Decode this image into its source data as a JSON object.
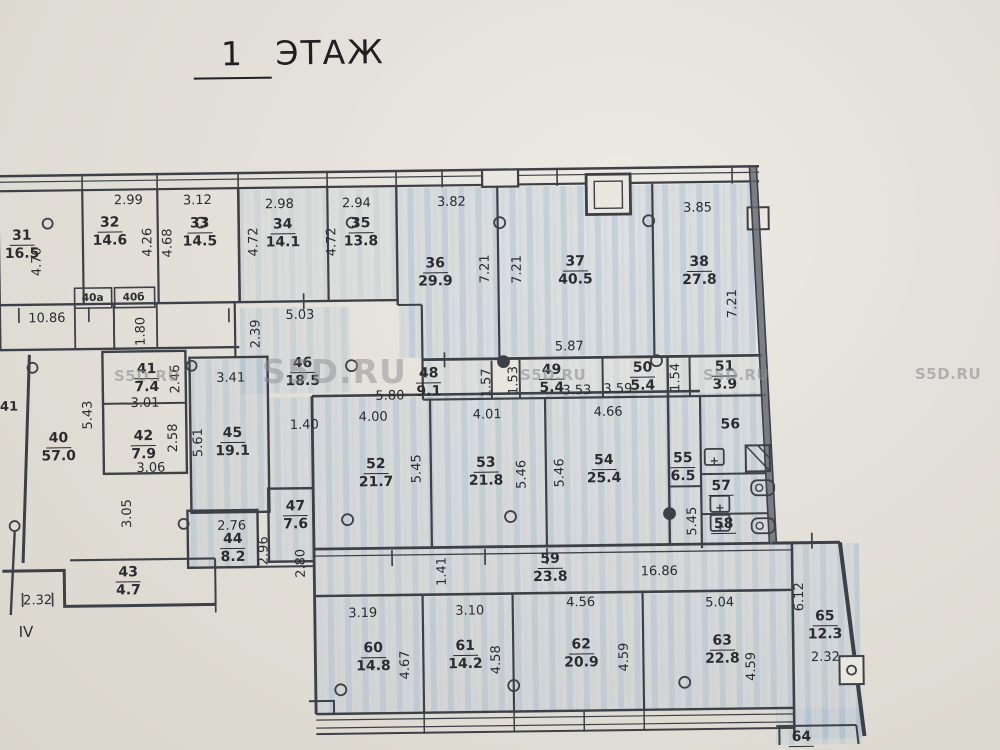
{
  "title": {
    "number": "1",
    "word": "ЭТАЖ"
  },
  "watermark": {
    "text": "S5D.RU"
  },
  "section_marker": "IV",
  "edge_label": "41",
  "closets": [
    {
      "label": "40а"
    },
    {
      "label": "40б"
    }
  ],
  "rooms": [
    {
      "number": "31",
      "area": "16.5"
    },
    {
      "number": "32",
      "area": "14.6"
    },
    {
      "number": "33",
      "area": "14.5"
    },
    {
      "number": "34",
      "area": "14.1"
    },
    {
      "number": "35",
      "area": "13.8"
    },
    {
      "number": "36",
      "area": "29.9"
    },
    {
      "number": "37",
      "area": "40.5"
    },
    {
      "number": "38",
      "area": "27.8"
    },
    {
      "number": "40",
      "area": "57.0"
    },
    {
      "number": "41",
      "area": "7.4"
    },
    {
      "number": "42",
      "area": "7.9"
    },
    {
      "number": "43",
      "area": "4.7"
    },
    {
      "number": "44",
      "area": "8.2"
    },
    {
      "number": "45",
      "area": "19.1"
    },
    {
      "number": "46",
      "area": "18.5"
    },
    {
      "number": "47",
      "area": "7.6"
    },
    {
      "number": "48",
      "area": "9.1"
    },
    {
      "number": "49",
      "area": "5.4"
    },
    {
      "number": "50",
      "area": "5.4"
    },
    {
      "number": "51",
      "area": "3.9"
    },
    {
      "number": "52",
      "area": "21.7"
    },
    {
      "number": "53",
      "area": "21.8"
    },
    {
      "number": "54",
      "area": "25.4"
    },
    {
      "number": "55",
      "area": "6.5"
    },
    {
      "number": "56",
      "area": ""
    },
    {
      "number": "57",
      "area": ""
    },
    {
      "number": "58",
      "area": ""
    },
    {
      "number": "59",
      "area": "23.8"
    },
    {
      "number": "60",
      "area": "14.8"
    },
    {
      "number": "61",
      "area": "14.2"
    },
    {
      "number": "62",
      "area": "20.9"
    },
    {
      "number": "63",
      "area": "22.8"
    },
    {
      "number": "64",
      "area": ""
    },
    {
      "number": "65",
      "area": "12.3"
    }
  ],
  "dims": [
    "2.99",
    "3.12",
    "2.98",
    "2.94",
    "3.82",
    "3.85",
    "4.70",
    "4.26",
    "4.68",
    "4.72",
    "4.72",
    "7.21",
    "7.21",
    "7.21",
    "10.86",
    "1.80",
    "5.03",
    "2.39",
    "5.87",
    "3.41",
    "5.43",
    "3.01",
    "2.46",
    "3.06",
    "2.58",
    "5.61",
    "1.40",
    "5.80",
    "1.57",
    "1.53",
    "3.53",
    "3.59",
    "1.54",
    "4.00",
    "4.01",
    "4.66",
    "5.45",
    "5.46",
    "5.46",
    "5.45",
    "3.05",
    "2.76",
    "2.96",
    "2.80",
    "2.32",
    "1.41",
    "16.86",
    "3.19",
    "3.10",
    "4.56",
    "5.04",
    "4.67",
    "4.58",
    "4.59",
    "4.59",
    "6.12",
    "2.32"
  ]
}
